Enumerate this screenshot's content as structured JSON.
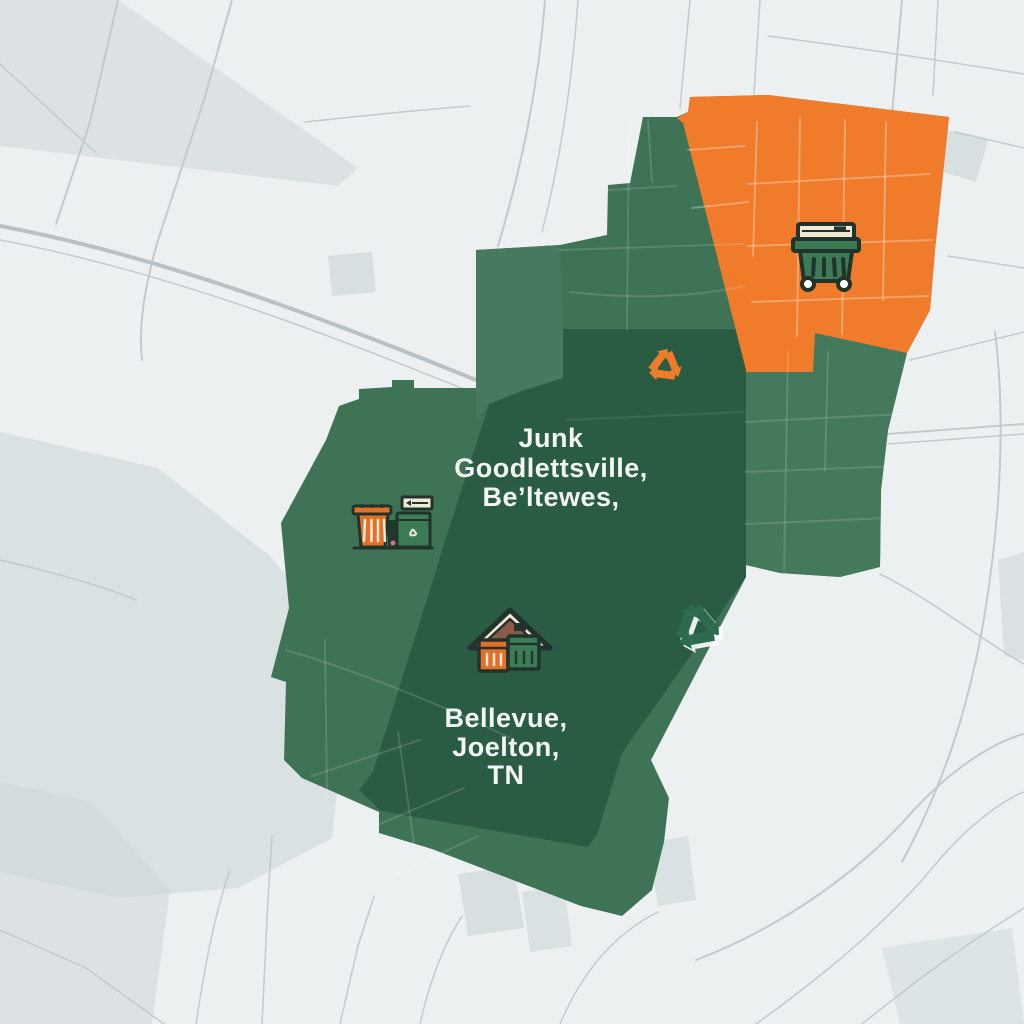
{
  "map": {
    "description": "Stylized service-area map illustration",
    "labels": {
      "north": [
        "Junk",
        "Goodlettsville,",
        "Be’ltewes,"
      ],
      "south": [
        "Bellevue,",
        "Joelton,",
        "TN"
      ]
    },
    "regions": [
      {
        "name": "service-area-main",
        "color": "#3e7356"
      },
      {
        "name": "service-area-north-wedge",
        "color": "#487a5e"
      },
      {
        "name": "service-area-east-zone",
        "color": "#45795c"
      },
      {
        "name": "service-area-core",
        "color": "#2a5c43"
      },
      {
        "name": "highlight-zone",
        "color": "#f07b2b"
      }
    ],
    "icons": [
      "green-dumpster-icon",
      "orange-trash-can-icon",
      "green-dumpster-with-sign-icon",
      "house-with-bins-icon",
      "orange-recycle-icon",
      "green-recycle-icon"
    ],
    "colors": {
      "map_background": "#edf0f1",
      "map_patch": "#cdd7d9",
      "road": "#c3c9cc",
      "road_major": "#b9c1c5",
      "label_text": "#f3f6f3",
      "icon_outline": "#22332b",
      "icon_cream": "#f1e9d4",
      "icon_orange": "#e2702a",
      "icon_green": "#3d7a56",
      "roof_brown": "#8b5b4a",
      "flower_pink": "#cf6f8e"
    }
  }
}
